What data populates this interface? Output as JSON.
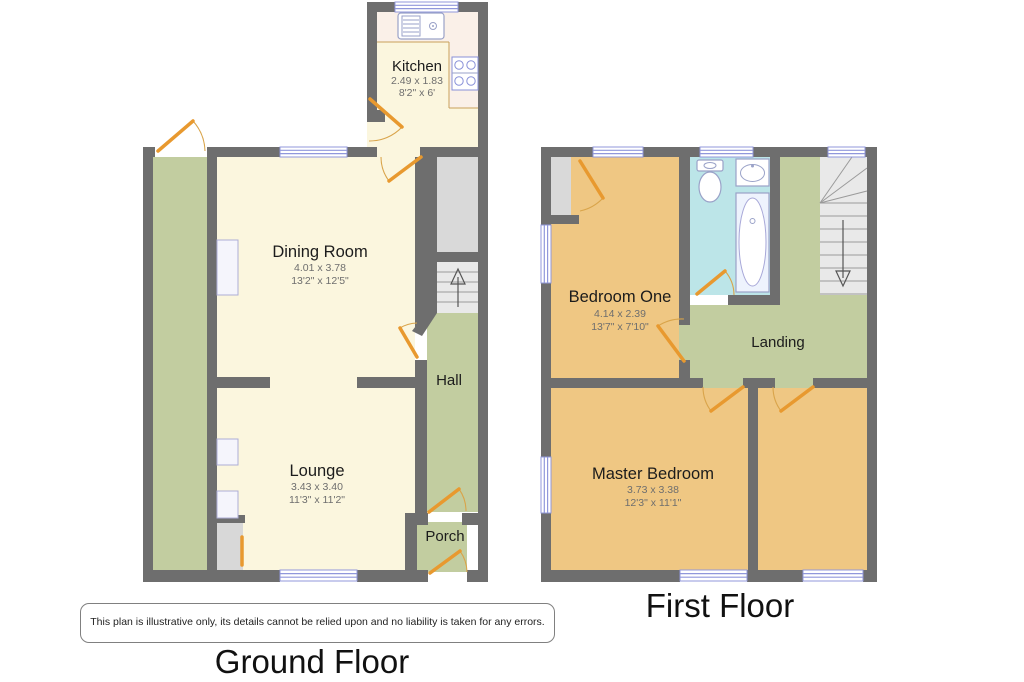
{
  "floors": [
    {
      "title": "Ground Floor",
      "rooms": [
        {
          "name": "Kitchen",
          "dims_metric": "2.49 x 1.83",
          "dims_imperial": "8'2\" x 6'"
        },
        {
          "name": "Dining Room",
          "dims_metric": "4.01 x 3.78",
          "dims_imperial": "13'2\" x 12'5\""
        },
        {
          "name": "Lounge",
          "dims_metric": "3.43 x 3.40",
          "dims_imperial": "11'3\" x 11'2\""
        },
        {
          "name": "Hall"
        },
        {
          "name": "Porch"
        }
      ]
    },
    {
      "title": "First Floor",
      "rooms": [
        {
          "name": "Bedroom One",
          "dims_metric": "4.14 x 2.39",
          "dims_imperial": "13'7\" x 7'10\""
        },
        {
          "name": "Landing"
        },
        {
          "name": "Master Bedroom",
          "dims_metric": "3.73 x 3.38",
          "dims_imperial": "12'3\" x 11'1\""
        }
      ]
    }
  ],
  "disclaimer": "This plan is illustrative only, its details cannot be relied upon and no liability is taken for any errors.",
  "colors": {
    "room_cream": "#fbf6de",
    "room_green": "#c2cda0",
    "room_orange": "#efc783",
    "room_cyan": "#bce5e8",
    "wall_gray": "#6e6e6e",
    "storage_gray": "#d9d9d9",
    "stairs_gray": "#e9e9e9",
    "door_orange": "#e8992f",
    "window_blue": "#8890d8",
    "counter_tint": "#faf0e8"
  }
}
